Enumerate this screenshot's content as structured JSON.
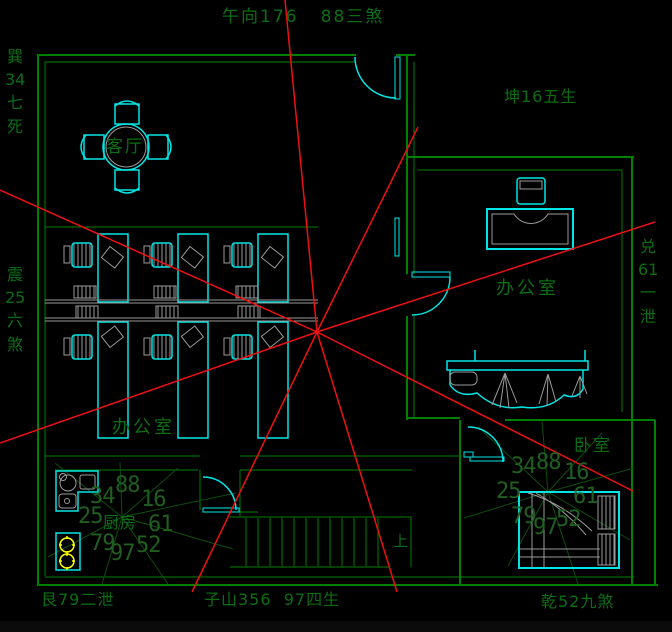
{
  "annotations": {
    "top": "午向176   88三煞",
    "top_left_vertical": "巽34七死",
    "top_right": "坤16五生",
    "left_vertical": "震25六煞",
    "right_vertical": "兑61一泄",
    "bottom_left": "艮79二泄",
    "bottom_center": "子山356  97四生",
    "bottom_right": "乾52九煞"
  },
  "rooms": {
    "living_room": "客厅",
    "office_main": "办公室",
    "office_right": "办公室",
    "bedroom": "卧室",
    "kitchen": "厨房",
    "stairs_up": "上"
  },
  "compass_kitchen": {
    "values": [
      "34",
      "88",
      "16",
      "25",
      "61",
      "79",
      "97",
      "52"
    ]
  },
  "compass_bedroom": {
    "values": [
      "34",
      "88",
      "16",
      "25",
      "61",
      "79",
      "97",
      "52"
    ]
  },
  "colors": {
    "wall": "#008000",
    "furniture": "#00e6e6",
    "detail": "#9a9a9a",
    "rose": "#0d4d0d",
    "text": "#0c6e14",
    "numbers": "#215e21",
    "red_line": "#ee1111",
    "burner": "#ffff00"
  }
}
